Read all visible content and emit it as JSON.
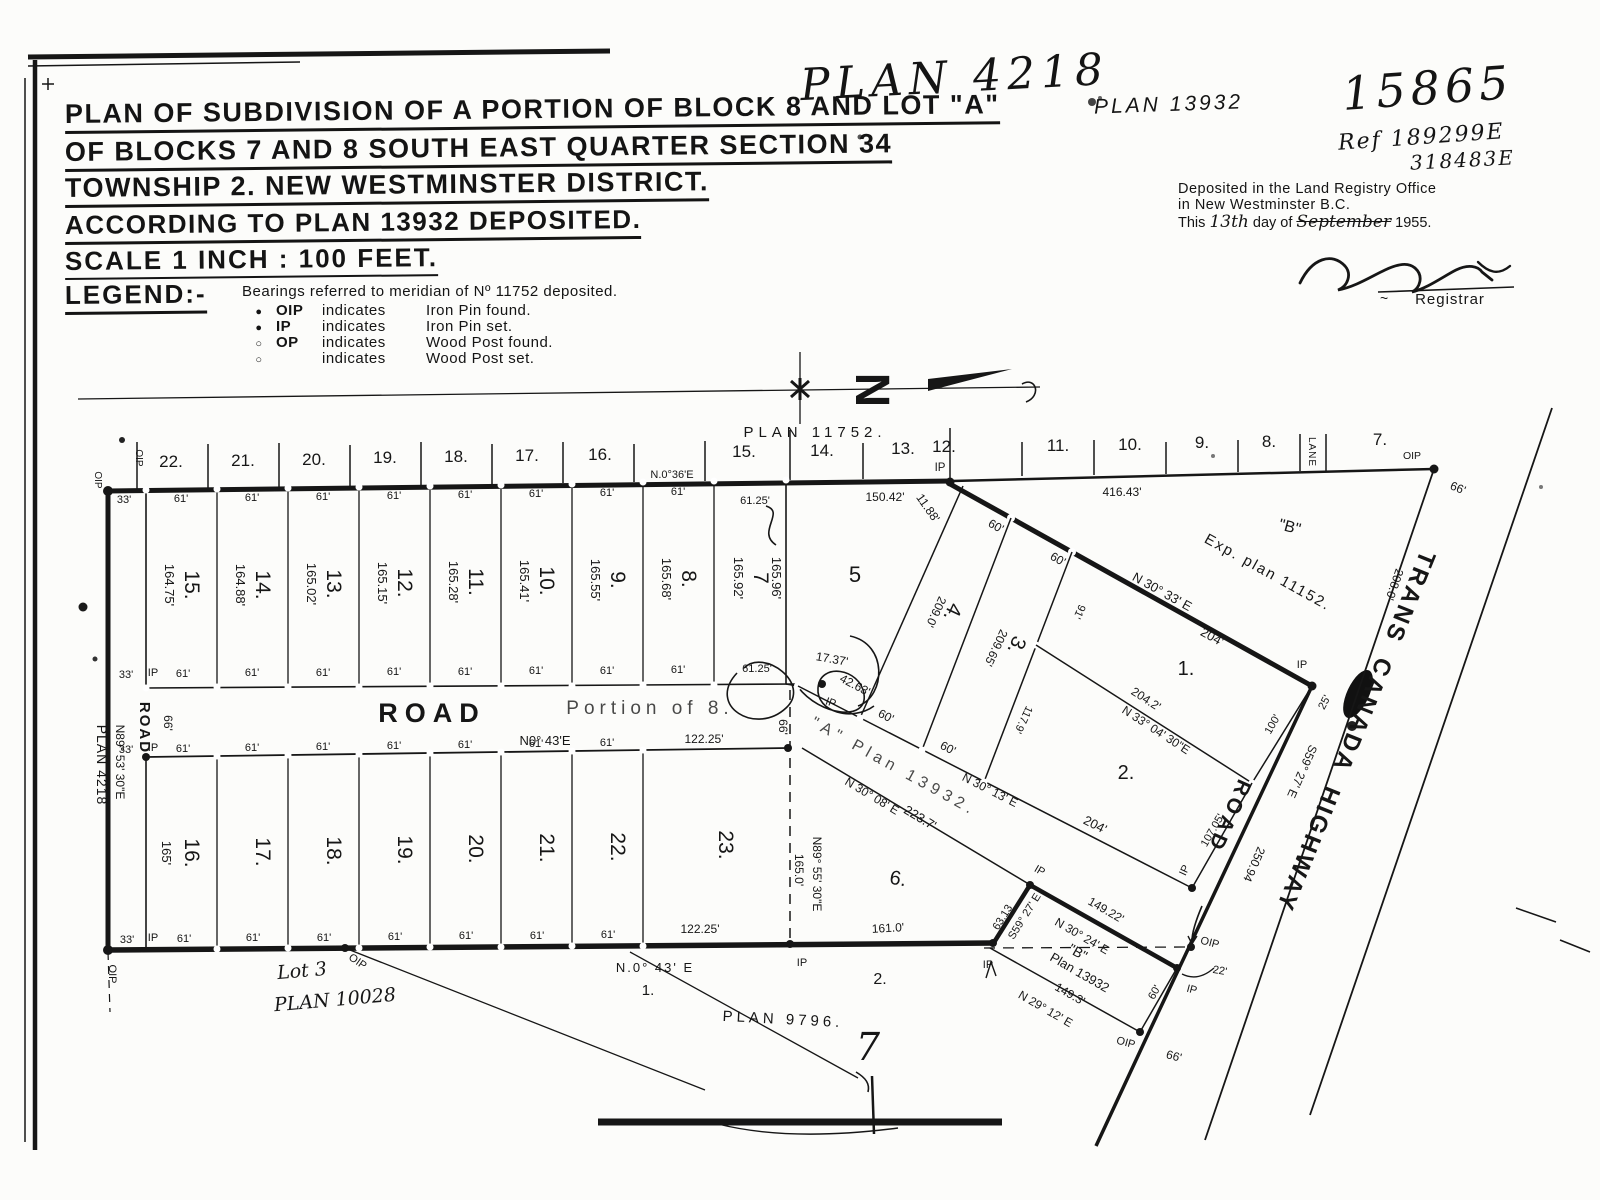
{
  "header": {
    "plan_hand": "PLAN 4218",
    "plan_ref_right": "PLAN 13932",
    "file_no": "15865",
    "ref1": "Ref 189299E",
    "ref2": "318483E",
    "title1": "PLAN OF SUBDIVISION OF A PORTION OF BLOCK 8 AND LOT \"A\"",
    "title2": "OF BLOCKS 7 AND 8 SOUTH EAST QUARTER SECTION 34",
    "title3": "TOWNSHIP 2. NEW WESTMINSTER DISTRICT.",
    "title4": "ACCORDING TO PLAN 13932 DEPOSITED.",
    "scale": "SCALE   1 INCH : 100 FEET.",
    "deposit1": "Deposited in the Land Registry Office",
    "deposit2": "in  New Westminster    B.C.",
    "deposit3_pre": "This",
    "deposit3_day": "13th",
    "deposit3_mid": "day of",
    "deposit3_month": "September",
    "deposit3_year": "1955.",
    "registrar": "Registrar",
    "tilde": "~"
  },
  "legend": {
    "heading": "LEGEND:-",
    "note": "Bearings referred  to meridian of Nº 11752 deposited.",
    "items": [
      {
        "sym": "●",
        "abbr": "OIP",
        "ind": "indicates",
        "desc": "Iron Pin  found."
      },
      {
        "sym": "●",
        "abbr": "IP",
        "ind": "indicates",
        "desc": "Iron Pin  set."
      },
      {
        "sym": "○",
        "abbr": "OP",
        "ind": "indicates",
        "desc": "Wood Post found."
      },
      {
        "sym": "○",
        "abbr": "",
        "ind": "indicates",
        "desc": "Wood Post set."
      }
    ]
  },
  "map": {
    "north_n": "N",
    "plan11752": "PLAN  11752.",
    "lots_top": [
      "22.",
      "21.",
      "20.",
      "19.",
      "18.",
      "17.",
      "16.",
      "15.",
      "14.",
      "13.",
      "12.",
      "11.",
      "10.",
      "9.",
      "8.",
      "7."
    ],
    "lane": "LANE",
    "b_n036": "N.0°36'E",
    "d150": "150.42'",
    "d1188": "11.88'",
    "d416": "416.43'",
    "d6125": "61.25'",
    "d17": "17.37'",
    "d42": "42.63'",
    "road": "ROAD",
    "portion": "Portion of 8.",
    "b_n043": "N0° 43'E",
    "b_n043b": "N.0° 43' E",
    "b_n8953": "N89° 53' 30\"E",
    "plan4218v": "PLAN 4218",
    "b_n8955": "N89° 55' 30\"E",
    "d165": "165.0'",
    "d165s": "165'",
    "upper_lots": [
      {
        "no": "15.",
        "len": "164.75'"
      },
      {
        "no": "14.",
        "len": "164.88'"
      },
      {
        "no": "13.",
        "len": "165.02'"
      },
      {
        "no": "12.",
        "len": "165.15'"
      },
      {
        "no": "11.",
        "len": "165.28'"
      },
      {
        "no": "10.",
        "len": "165.41'"
      },
      {
        "no": "9.",
        "len": "165.55'"
      },
      {
        "no": "8.",
        "len": "165.68'"
      },
      {
        "no": "7",
        "len": "165.92'"
      }
    ],
    "d16596": "165.96'",
    "lower_lots": [
      "16.",
      "17.",
      "18.",
      "19.",
      "20.",
      "21.",
      "22.",
      "23."
    ],
    "d122": "122.25'",
    "lot5": "5",
    "lot4": "4.",
    "lot3": "3.",
    "lot2": "2.",
    "lot1": "1.",
    "lot6": "6.",
    "d209": "209.0'",
    "d20965": "209.65'",
    "d91": "91'",
    "d1179": "117.9'",
    "b_n3033": "N 30° 33' E",
    "d204": "204'",
    "d2042": "204.2'",
    "b_n3304": "N 33° 04' 30\"E",
    "b_n3013": "N 30° 13' E",
    "b_n3008": "N 30° 08' E",
    "d2237": "223.7'",
    "aplan": "\"A\" Plan 13932.",
    "bq": "\"B\"",
    "exp": "Exp. plan 11152.",
    "d208": "208.0'",
    "d60": "60'",
    "d66": "66'",
    "d33": "33'",
    "d61": "61'",
    "d100": "100'",
    "d10705": "107.05'",
    "d25": "25'",
    "d25094": "250.94",
    "s5927": "S59° 27' E",
    "tch": "TRANS CANADA HIGHWAY",
    "d14922": "149.22'",
    "b_n3024": "N 30° 24' E",
    "plan13932b": "Plan 13932",
    "d1493": "149.3'",
    "b_n2912": "N 29° 12' E",
    "d6313": "63.13",
    "d22": "22'",
    "d161": "161.0'",
    "ip": "IP",
    "oip": "OIP",
    "lot3txt": "Lot 3",
    "plan10028": "PLAN 10028",
    "plan9796": "PLAN   9796.",
    "seven": "7",
    "one": "1.",
    "two": "2."
  }
}
